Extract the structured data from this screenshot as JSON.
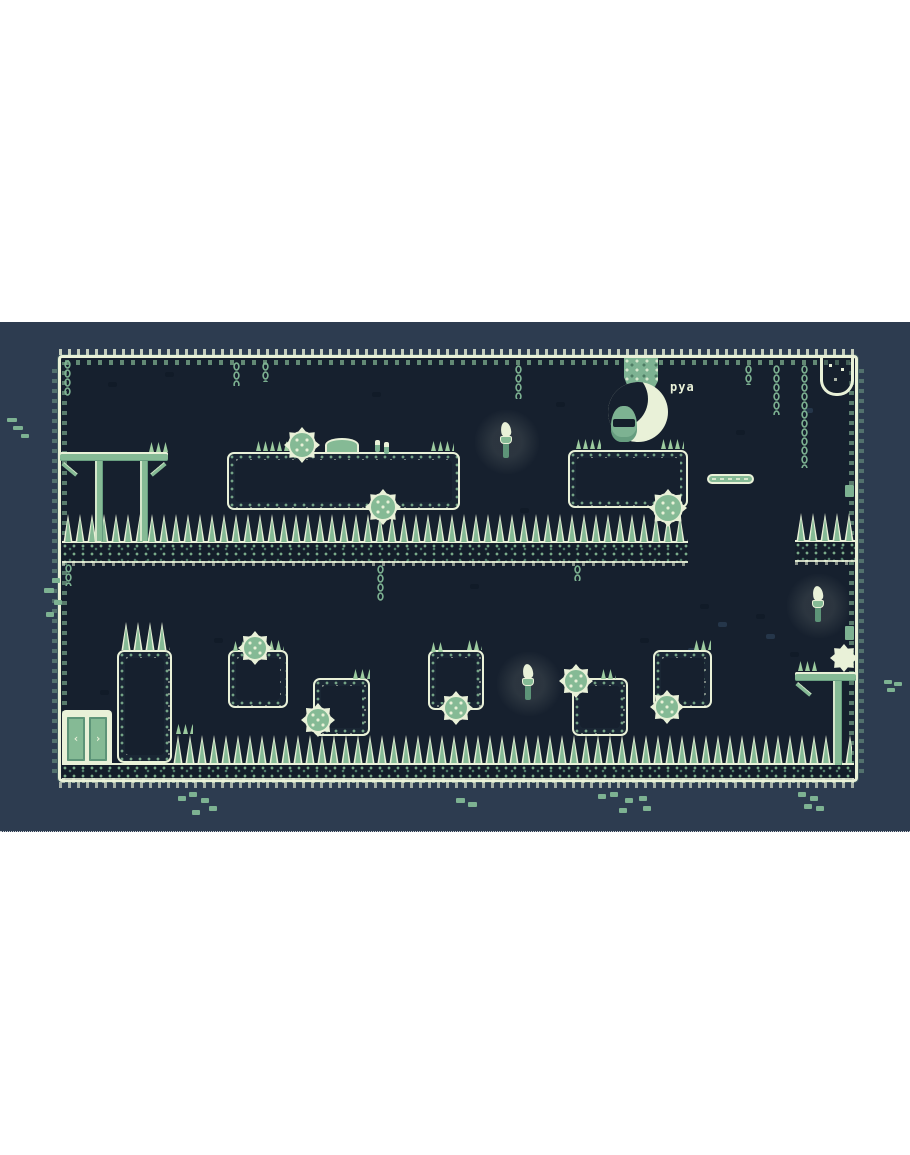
{
  "window": {
    "width": 910,
    "height": 1155,
    "game_band_top": 322,
    "game_band_height": 510
  },
  "speech": {
    "text": "pya"
  },
  "palette": {
    "page_bg": "#ffffff",
    "outer_bg": "#2d3c50",
    "level_bg": "#16202e",
    "cream": "#e9f1d8",
    "green": "#85ba95",
    "green_dark": "#5d9478",
    "chain_green": "#7db292",
    "glow": "rgba(233,241,216,0.10)"
  },
  "level": {
    "frame": {
      "x": 58,
      "y": 33,
      "w": 800,
      "h": 427
    },
    "strips": [
      {
        "x": 62,
        "y": 219,
        "w": 626,
        "h": 22
      },
      {
        "x": 795,
        "y": 218,
        "w": 60,
        "h": 22
      },
      {
        "x": 62,
        "y": 441,
        "w": 792,
        "h": 17
      }
    ],
    "spike_rows": [
      {
        "x": 62,
        "y": 192,
        "w": 626,
        "h": 28
      },
      {
        "x": 795,
        "y": 191,
        "w": 60,
        "h": 28
      },
      {
        "x": 120,
        "y": 300,
        "w": 50,
        "h": 28
      },
      {
        "x": 172,
        "y": 413,
        "w": 680,
        "h": 28
      }
    ],
    "blocks": [
      {
        "x": 227,
        "y": 130,
        "w": 233,
        "h": 58
      },
      {
        "x": 568,
        "y": 128,
        "w": 120,
        "h": 58
      },
      {
        "x": 117,
        "y": 328,
        "w": 55,
        "h": 113
      },
      {
        "x": 228,
        "y": 328,
        "w": 60,
        "h": 58
      },
      {
        "x": 313,
        "y": 356,
        "w": 57,
        "h": 58
      },
      {
        "x": 428,
        "y": 328,
        "w": 56,
        "h": 60
      },
      {
        "x": 572,
        "y": 356,
        "w": 56,
        "h": 58
      },
      {
        "x": 653,
        "y": 328,
        "w": 59,
        "h": 58
      }
    ],
    "saws": [
      {
        "x": 284,
        "y": 105,
        "d": 36
      },
      {
        "x": 365,
        "y": 167,
        "d": 36
      },
      {
        "x": 649,
        "y": 167,
        "d": 38
      },
      {
        "x": 238,
        "y": 309,
        "d": 34
      },
      {
        "x": 301,
        "y": 381,
        "d": 34
      },
      {
        "x": 439,
        "y": 369,
        "d": 34
      },
      {
        "x": 559,
        "y": 342,
        "d": 34
      },
      {
        "x": 650,
        "y": 368,
        "d": 34
      }
    ],
    "chains": [
      {
        "x": 64,
        "y": 38,
        "h": 36
      },
      {
        "x": 233,
        "y": 40,
        "h": 24
      },
      {
        "x": 262,
        "y": 40,
        "h": 20
      },
      {
        "x": 515,
        "y": 43,
        "h": 34
      },
      {
        "x": 745,
        "y": 43,
        "h": 20
      },
      {
        "x": 773,
        "y": 43,
        "h": 50
      },
      {
        "x": 801,
        "y": 43,
        "h": 103
      },
      {
        "x": 65,
        "y": 242,
        "h": 22
      },
      {
        "x": 377,
        "y": 243,
        "h": 36
      },
      {
        "x": 574,
        "y": 243,
        "h": 16
      }
    ],
    "torches": [
      {
        "x": 497,
        "y": 100
      },
      {
        "x": 519,
        "y": 342
      },
      {
        "x": 809,
        "y": 264
      }
    ],
    "thin_platforms": [
      {
        "x": 707,
        "y": 152,
        "w": 47,
        "h": 10
      }
    ],
    "grass": [
      [
        255,
        119,
        40
      ],
      [
        430,
        119,
        24
      ],
      [
        148,
        120,
        22
      ],
      [
        575,
        117,
        26
      ],
      [
        660,
        117,
        24
      ],
      [
        232,
        319,
        16
      ],
      [
        268,
        318,
        16
      ],
      [
        352,
        347,
        18
      ],
      [
        430,
        320,
        14
      ],
      [
        466,
        318,
        16
      ],
      [
        600,
        347,
        16
      ],
      [
        693,
        318,
        18
      ],
      [
        797,
        339,
        22
      ],
      [
        175,
        402,
        18
      ]
    ],
    "dome": {
      "x": 325,
      "y": 116,
      "w": 34,
      "h": 14
    },
    "mushrooms": [
      {
        "x": 374,
        "y": 117
      }
    ],
    "speckles_dark": [
      [
        108,
        60
      ],
      [
        165,
        50
      ],
      [
        372,
        70
      ],
      [
        556,
        80
      ],
      [
        640,
        56
      ],
      [
        736,
        108
      ],
      [
        520,
        186
      ],
      [
        100,
        368
      ],
      [
        214,
        316
      ],
      [
        470,
        262
      ],
      [
        640,
        316
      ],
      [
        700,
        282
      ],
      [
        756,
        292
      ],
      [
        790,
        330
      ]
    ],
    "speckles_light": [
      [
        718,
        300
      ],
      [
        766,
        312
      ],
      [
        688,
        326
      ],
      [
        804,
        86
      ]
    ],
    "outer_clusters": [
      {
        "x": 7,
        "y": 96,
        "cells": [
          [
            0,
            0,
            10,
            4
          ],
          [
            6,
            8,
            10,
            4
          ],
          [
            14,
            16,
            8,
            4
          ]
        ]
      },
      {
        "x": 884,
        "y": 358,
        "cells": [
          [
            0,
            0,
            8,
            4
          ],
          [
            10,
            2,
            8,
            4
          ],
          [
            3,
            8,
            8,
            4
          ]
        ]
      },
      {
        "x": 178,
        "y": 470,
        "cells": [
          [
            0,
            4,
            8,
            5
          ],
          [
            11,
            0,
            8,
            5
          ],
          [
            23,
            6,
            8,
            5
          ],
          [
            31,
            14,
            8,
            5
          ],
          [
            14,
            18,
            8,
            5
          ]
        ]
      },
      {
        "x": 456,
        "y": 476,
        "cells": [
          [
            0,
            0,
            9,
            5
          ],
          [
            12,
            4,
            9,
            5
          ]
        ]
      },
      {
        "x": 598,
        "y": 470,
        "cells": [
          [
            0,
            2,
            8,
            5
          ],
          [
            12,
            0,
            8,
            5
          ],
          [
            27,
            6,
            8,
            5
          ],
          [
            41,
            4,
            8,
            5
          ],
          [
            21,
            16,
            8,
            5
          ],
          [
            45,
            14,
            8,
            5
          ]
        ]
      },
      {
        "x": 798,
        "y": 470,
        "cells": [
          [
            0,
            0,
            8,
            5
          ],
          [
            12,
            4,
            8,
            5
          ],
          [
            6,
            12,
            8,
            5
          ],
          [
            18,
            14,
            8,
            5
          ]
        ]
      },
      {
        "x": 44,
        "y": 256,
        "cells": [
          [
            8,
            0,
            8,
            5
          ],
          [
            0,
            10,
            10,
            5
          ],
          [
            10,
            22,
            8,
            5
          ],
          [
            2,
            34,
            8,
            5
          ]
        ]
      },
      {
        "x": 845,
        "y": 163,
        "cells": [
          [
            0,
            0,
            9,
            12
          ]
        ]
      },
      {
        "x": 845,
        "y": 304,
        "cells": [
          [
            0,
            0,
            9,
            14
          ]
        ]
      }
    ]
  },
  "structures": {
    "gallows": {
      "x": 60,
      "y": 130,
      "bar_w": 108,
      "leg_h": 80
    },
    "right_table": {
      "x": 795,
      "y": 350,
      "bar_w": 61,
      "leg_h": 84
    },
    "door": {
      "x": 62,
      "y": 388,
      "w": 50,
      "h": 53,
      "left_glyph": "‹",
      "right_glyph": "›"
    },
    "alcove": {
      "x": 820,
      "y": 36,
      "w": 34,
      "h": 38
    },
    "vine": {
      "x": 624,
      "y": 36,
      "w": 34,
      "h": 46
    },
    "character": {
      "x": 596,
      "y": 52,
      "w": 110,
      "h": 75
    }
  }
}
